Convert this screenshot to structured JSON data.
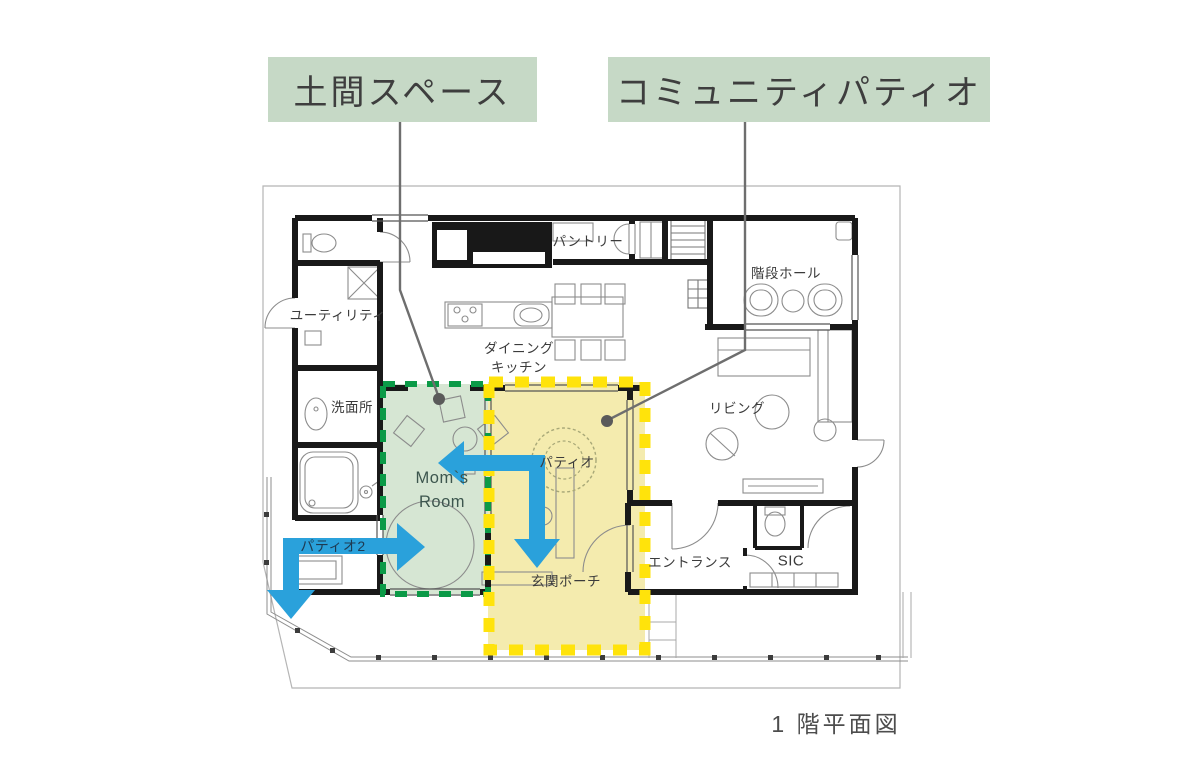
{
  "figure": {
    "callouts": {
      "doma": "土間スペース",
      "community_patio": "コミュニティパティオ"
    },
    "caption": "1 階平面図",
    "rooms": {
      "utility": "ユーティリティ",
      "pantry": "パントリー",
      "dining": "ダイニング",
      "kitchen": "キッチン",
      "stair_hall": "階段ホール",
      "washroom": "洗面所",
      "living": "リビング",
      "patio": "パティオ",
      "moms_room_1": "Mom`s",
      "moms_room_2": "Room",
      "patio2": "パティオ2",
      "entrance_porch": "玄関ポーチ",
      "entrance": "エントランス",
      "shoe_closet": "SIC"
    },
    "colors": {
      "callout_bg": "#c6d9c6",
      "doma_zone_fill": "#d3e4cf",
      "doma_zone_dash": "#0b9a47",
      "patio_zone_fill": "#f2e8a3",
      "patio_zone_dash": "#ffe30b",
      "flow_arrow": "#2aa1db",
      "wall": "#191919"
    }
  }
}
